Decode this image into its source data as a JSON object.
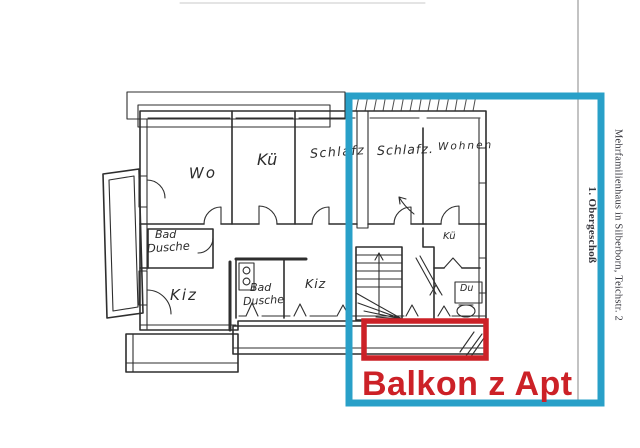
{
  "colors": {
    "highlight_blue": "#29a0c8",
    "highlight_red": "#cc2127",
    "ink": "#2e2e2e",
    "page_background": "#ffffff"
  },
  "plan": {
    "rooms": {
      "wo": "Wo",
      "kueche": "Kü",
      "schlafz_1": "Schlafz",
      "schlafz_2": "Schlafz.",
      "wohnen": "Wohnen",
      "bad_1_l1": "Bad",
      "bad_1_l2": "Dusche",
      "kiz_1": "Kiz",
      "bad_2_l1": "Bad",
      "bad_2_l2": "Dusche",
      "kiz_2": "Kiz",
      "kueche_2": "Kü",
      "du": "Du"
    }
  },
  "annotations": {
    "balkon_label": "Balkon z Apt"
  },
  "side_labels": {
    "building": "Mehrfamilienhaus in Silberborn, Teichstr. 2",
    "floor": "1. Obergeschoß"
  }
}
